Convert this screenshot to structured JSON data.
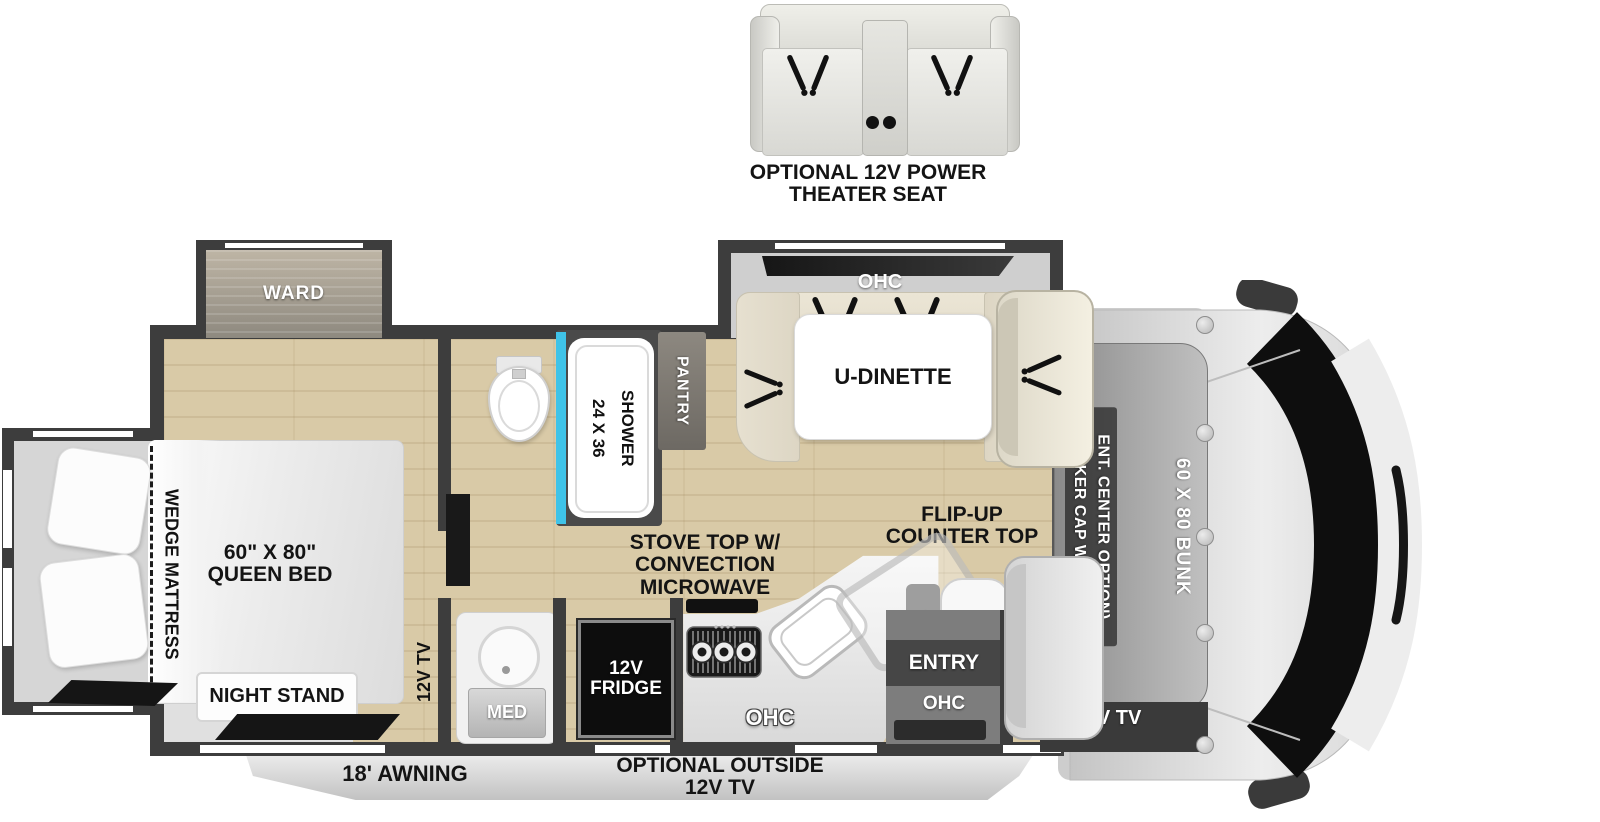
{
  "theater_seat": {
    "line1": "OPTIONAL 12V POWER",
    "line2": "THEATER SEAT"
  },
  "slides": {
    "ward": "WARD",
    "dinette_ohc": "OHC"
  },
  "dinette": {
    "label": "U-DINETTE"
  },
  "bedroom": {
    "wedge": "WEDGE MATTRESS",
    "bed_l1": "60\" X 80\"",
    "bed_l2": "QUEEN BED",
    "night_stand": "NIGHT STAND",
    "tv": "12V TV"
  },
  "bath": {
    "shower_l1": "24 X 36",
    "shower_l2": "SHOWER",
    "med": "MED",
    "pantry": "PANTRY"
  },
  "kitchen": {
    "stove_l1": "STOVE TOP W/",
    "stove_l2": "CONVECTION",
    "stove_l3": "MICROWAVE",
    "fridge_l1": "12V",
    "fridge_l2": "FRIDGE",
    "ohc": "OHC",
    "flip_l1": "FLIP-UP",
    "flip_l2": "COUNTER TOP",
    "counter_ohc": "OHC"
  },
  "entry": {
    "label": "ENTRY",
    "ohc": "OHC"
  },
  "cab": {
    "trekker_l1": "(TREKKER CAP W/ BUILT-IN",
    "trekker_l2": "ENT. CENTER OPTION)",
    "bunk": "60 X 80 BUNK",
    "tv": "12V TV"
  },
  "exterior": {
    "awning": "18' AWNING",
    "outside_l1": "OPTIONAL OUTSIDE",
    "outside_l2": "12V TV"
  },
  "colors": {
    "wall": "#3d3d3d",
    "wood": "#d9caa7",
    "shower_glass": "#3fc3e8"
  }
}
